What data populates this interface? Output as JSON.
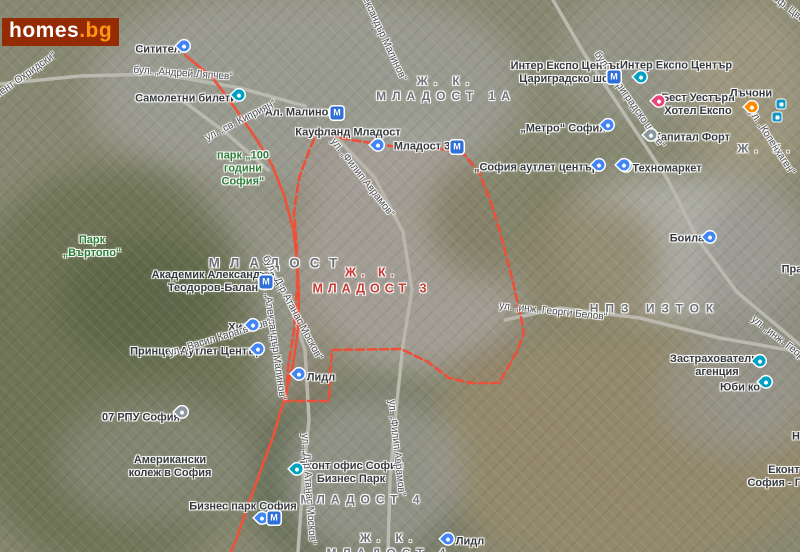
{
  "page": {
    "width": 800,
    "height": 552
  },
  "brand": {
    "logo_main": "homes",
    "logo_suffix": ".bg",
    "logo_bg": "#952b05",
    "logo_main_color": "#ffffff",
    "logo_suffix_color": "#ff9412"
  },
  "map": {
    "colors": {
      "boundary": "#ee4f38",
      "highlight_road": "#ee5238",
      "base_road": "#b9b9af",
      "district_text": "#6e7277",
      "district_highlight_text": "#c63b30",
      "park_text": "#2d7d37",
      "place_text": "#35393d",
      "street_text": "#4c5055",
      "pin_blue": "#4285f4",
      "pin_teal": "#00a1c2",
      "pin_pink": "#e7467c",
      "pin_orange": "#fb8c00",
      "pin_gray": "#8a97a0",
      "metro_icon_bg": "#2e6fd8",
      "bus_icon_bg": "#1596c6"
    },
    "metro_glyph": "М",
    "districts": [
      {
        "id": "mladost-1a",
        "lines": [
          "Ж. К.",
          "МЛАДОСТ 1А"
        ],
        "x": 446,
        "y": 88,
        "size": 12,
        "ls": 6
      },
      {
        "id": "mladost",
        "lines": [
          "МЛАДОСТ"
        ],
        "x": 278,
        "y": 263,
        "size": 13.5,
        "ls": 10
      },
      {
        "id": "mladost-3",
        "lines": [
          "Ж. К.",
          "МЛАДОСТ 3"
        ],
        "x": 372,
        "y": 280,
        "size": 12.5,
        "ls": 5,
        "color": "#c63b30"
      },
      {
        "id": "npz-iztok",
        "lines": [
          "НПЗ ИЗТОК"
        ],
        "x": 655,
        "y": 308,
        "size": 12,
        "ls": 7
      },
      {
        "id": "mladost-4",
        "lines": [
          "МЛАДОСТ 4"
        ],
        "x": 363,
        "y": 499,
        "size": 12,
        "ls": 6
      },
      {
        "id": "zhk-mladost-4",
        "lines": [
          "Ж. К.",
          "МЛАДОСТ 4"
        ],
        "x": 389,
        "y": 545,
        "size": 12,
        "ls": 6
      },
      {
        "id": "druzhba",
        "lines": [
          "Ж. К. ДРУЖБА"
        ],
        "x": 815,
        "y": 148,
        "size": 12,
        "ls": 6
      }
    ],
    "places": [
      {
        "id": "sititel",
        "lines": [
          "Ситител"
        ],
        "x": 158,
        "y": 50
      },
      {
        "id": "samoletni-bileti",
        "lines": [
          "Самолетни билети"
        ],
        "x": 186,
        "y": 99
      },
      {
        "id": "al-malinov-station",
        "lines": [
          "Ал. Малинов"
        ],
        "x": 300,
        "y": 113
      },
      {
        "id": "kaufland-mladost",
        "lines": [
          "Кауфланд Младост"
        ],
        "x": 348,
        "y": 133
      },
      {
        "id": "mladost-3-station",
        "lines": [
          "Младост 3"
        ],
        "x": 422,
        "y": 147
      },
      {
        "id": "park-100-godini-sofia",
        "lines": [
          "парк „100",
          "години",
          "София“"
        ],
        "x": 243,
        "y": 169,
        "color": "#2d7d37"
      },
      {
        "id": "inter-expo-station",
        "lines": [
          "Интер Експо Център -",
          "Цариградско шосе"
        ],
        "x": 570,
        "y": 73
      },
      {
        "id": "inter-expo-center",
        "lines": [
          "Интер Експо Център"
        ],
        "x": 676,
        "y": 66
      },
      {
        "id": "best-western-hotel-expo",
        "lines": [
          "Бест Уестърн",
          "Хотел Експо"
        ],
        "x": 698,
        "y": 105
      },
      {
        "id": "lachoni",
        "lines": [
          "Лъчони"
        ],
        "x": 751,
        "y": 94
      },
      {
        "id": "metro-sofia",
        "lines": [
          "„Метро“ София"
        ],
        "x": 563,
        "y": 129
      },
      {
        "id": "kapital-fort",
        "lines": [
          "Капитал Форт"
        ],
        "x": 692,
        "y": 138
      },
      {
        "id": "tehnomarket",
        "lines": [
          "Техномаркет"
        ],
        "x": 667,
        "y": 169
      },
      {
        "id": "sofia-outlet-center",
        "lines": [
          "„София аутлет център“"
        ],
        "x": 539,
        "y": 168
      },
      {
        "id": "boila",
        "lines": [
          "Боила"
        ],
        "x": 687,
        "y": 239
      },
      {
        "id": "praktiker",
        "lines": [
          "Практикер"
        ],
        "x": 810,
        "y": 270
      },
      {
        "id": "park-vartopo",
        "lines": [
          "Парк",
          "„Въртопо“"
        ],
        "x": 92,
        "y": 247,
        "color": "#2d7d37"
      },
      {
        "id": "akademik-teodorov-balan",
        "lines": [
          "Академик Александър",
          "Теодоров-Балан"
        ],
        "x": 213,
        "y": 282
      },
      {
        "id": "zastrahovatelna-agencia",
        "lines": [
          "Застрахователна",
          "агенция"
        ],
        "x": 717,
        "y": 366
      },
      {
        "id": "yubi-ko",
        "lines": [
          "Юби ко"
        ],
        "x": 740,
        "y": 388
      },
      {
        "id": "rpu-07-sofia",
        "lines": [
          "07 РПУ София"
        ],
        "x": 141,
        "y": 418
      },
      {
        "id": "american-college-sofia",
        "lines": [
          "Американски",
          "колеж в София"
        ],
        "x": 170,
        "y": 467
      },
      {
        "id": "hit",
        "lines": [
          "Хит"
        ],
        "x": 238,
        "y": 328
      },
      {
        "id": "princess-outlet-center",
        "lines": [
          "Принцес Аутлет Център"
        ],
        "x": 196,
        "y": 352
      },
      {
        "id": "lidl-west",
        "lines": [
          "Лидл"
        ],
        "x": 321,
        "y": 378
      },
      {
        "id": "ekont-business-park",
        "lines": [
          "Еконт офис София",
          "Бизнес Парк"
        ],
        "x": 351,
        "y": 473
      },
      {
        "id": "business-park-sofia",
        "lines": [
          "Бизнес парк София"
        ],
        "x": 243,
        "y": 507
      },
      {
        "id": "lidl-south",
        "lines": [
          "Лидл"
        ],
        "x": 470,
        "y": 542
      },
      {
        "id": "ekont-gorublyane",
        "lines": [
          "Еконт офис",
          "София - Горубляне"
        ],
        "x": 800,
        "y": 477
      },
      {
        "id": "partial-n",
        "lines": [
          "Н"
        ],
        "x": 796,
        "y": 437
      }
    ],
    "streets": [
      {
        "id": "andrey-lyapchev",
        "text": "бул. „Андрей Ляпчев“",
        "x": 183,
        "y": 74,
        "rot": 4
      },
      {
        "id": "sv-kipriyan",
        "text": "ул. „св. Киприян“",
        "x": 241,
        "y": 121,
        "rot": -27
      },
      {
        "id": "kliment-ohridski",
        "text": "бул. „Климент Охридски“",
        "x": 8,
        "y": 88,
        "rot": -35
      },
      {
        "id": "al-malinov-top",
        "text": "бул. „Александър Малинов“",
        "x": 376,
        "y": 22,
        "rot": 65
      },
      {
        "id": "filip-avramov-1",
        "text": "ул. „Филип Аврамов“",
        "x": 362,
        "y": 178,
        "rot": 52
      },
      {
        "id": "filip-avramov-2",
        "text": "ул. „Филип Аврамов“",
        "x": 396,
        "y": 448,
        "rot": 84
      },
      {
        "id": "atanas-moskov-1",
        "text": "бул. „Д-р Атанас Москов“",
        "x": 292,
        "y": 308,
        "rot": 62
      },
      {
        "id": "atanas-moskov-2",
        "text": "ул. „Д-р Атанас Москов“",
        "x": 308,
        "y": 489,
        "rot": 86
      },
      {
        "id": "al-malinov-mid",
        "text": "бул. „Александър Малинов“",
        "x": 273,
        "y": 336,
        "rot": 82
      },
      {
        "id": "vasil-karagyozov",
        "text": "ул. „Васил Карагьозов“",
        "x": 220,
        "y": 338,
        "rot": -17
      },
      {
        "id": "tsarigradsko-shose",
        "text": "бул. „Цариградско шосе“",
        "x": 629,
        "y": 100,
        "rot": 55
      },
      {
        "id": "georgi-belov-1",
        "text": "ул. „инж. Георги Белов“",
        "x": 553,
        "y": 312,
        "rot": 6
      },
      {
        "id": "georgi-belov-2",
        "text": "ул. „инж. Георги Белов“",
        "x": 795,
        "y": 352,
        "rot": 38
      },
      {
        "id": "prof-tsvetan-lazarov",
        "text": "ул. „проф. Цветан Лазаров“",
        "x": 800,
        "y": 18,
        "rot": 38
      },
      {
        "id": "kopenhagen",
        "text": "бул. „Копенхаген“",
        "x": 770,
        "y": 140,
        "rot": 57
      }
    ],
    "markers": [
      {
        "id": "sititel-pin",
        "type": "pin",
        "color": "#4285f4",
        "x": 184,
        "y": 47
      },
      {
        "id": "samoletni-bileti-pin",
        "type": "pin",
        "color": "#00a1c2",
        "x": 239,
        "y": 96
      },
      {
        "id": "kaufland-pin",
        "type": "pin",
        "color": "#4285f4",
        "x": 378,
        "y": 146
      },
      {
        "id": "inter-expo-center-pin",
        "type": "pin",
        "color": "#00a1c2",
        "x": 641,
        "y": 78
      },
      {
        "id": "best-western-pin",
        "type": "pin",
        "color": "#e7467c",
        "x": 659,
        "y": 102
      },
      {
        "id": "lachoni-pin",
        "type": "pin",
        "color": "#fb8c00",
        "x": 752,
        "y": 108
      },
      {
        "id": "metro-sofia-pin",
        "type": "pin",
        "color": "#4285f4",
        "x": 608,
        "y": 126
      },
      {
        "id": "kapital-fort-pin",
        "type": "pin",
        "color": "#8a97a0",
        "x": 651,
        "y": 136
      },
      {
        "id": "tehnomarket-pin",
        "type": "pin",
        "color": "#4285f4",
        "x": 626,
        "y": 167
      },
      {
        "id": "sofia-outlet-pin-1",
        "type": "pin",
        "color": "#4285f4",
        "x": 599,
        "y": 166
      },
      {
        "id": "sofia-outlet-pin-2",
        "type": "pin",
        "color": "#4285f4",
        "x": 624,
        "y": 166
      },
      {
        "id": "boila-pin",
        "type": "pin",
        "color": "#4285f4",
        "x": 710,
        "y": 238
      },
      {
        "id": "hit-pin",
        "type": "pin",
        "color": "#4285f4",
        "x": 253,
        "y": 326
      },
      {
        "id": "princess-outlet-pin",
        "type": "pin",
        "color": "#4285f4",
        "x": 258,
        "y": 350
      },
      {
        "id": "lidl-west-pin",
        "type": "pin",
        "color": "#4285f4",
        "x": 299,
        "y": 375
      },
      {
        "id": "zastrahovatelna-pin",
        "type": "pin",
        "color": "#00a1c2",
        "x": 760,
        "y": 362
      },
      {
        "id": "yubi-ko-pin",
        "type": "pin",
        "color": "#00a1c2",
        "x": 766,
        "y": 383
      },
      {
        "id": "rpu-07-pin",
        "type": "pin",
        "color": "#8a97a0",
        "x": 182,
        "y": 413
      },
      {
        "id": "ekont-business-park-pin",
        "type": "pin",
        "color": "#00a1c2",
        "x": 297,
        "y": 470
      },
      {
        "id": "business-park-pin",
        "type": "pin",
        "color": "#4285f4",
        "x": 262,
        "y": 519
      },
      {
        "id": "lidl-south-pin",
        "type": "pin",
        "color": "#4285f4",
        "x": 448,
        "y": 540
      },
      {
        "id": "al-malinov-metro",
        "type": "metro",
        "x": 337,
        "y": 113
      },
      {
        "id": "mladost-3-metro",
        "type": "metro",
        "x": 457,
        "y": 147
      },
      {
        "id": "inter-expo-metro",
        "type": "metro",
        "x": 614,
        "y": 77
      },
      {
        "id": "teodorov-balan-metro",
        "type": "metro",
        "x": 266,
        "y": 282
      },
      {
        "id": "business-park-metro",
        "type": "metro",
        "x": 274,
        "y": 518
      },
      {
        "id": "bus-stop-1",
        "type": "bus",
        "x": 781,
        "y": 104
      },
      {
        "id": "bus-stop-2",
        "type": "bus",
        "x": 777,
        "y": 117
      }
    ],
    "boundary_polygon": "318,130 345,139 372,143 403,148 433,148 462,152 479,172 492,205 503,243 512,278 520,312 524,333 517,352 499,383 471,383 449,378 428,362 401,349 332,350 330,377 329,401 286,401 288,368 294,330 297,288 297,247 294,213 299,178 309,151",
    "highlight_road": "185,55 212,77 235,108 257,140 272,165 284,195 293,228 297,260 299,295 298,330 293,365 284,400 273,437 259,475 247,508 236,540 231,552",
    "base_roads": [
      {
        "id": "road-lyapchev",
        "points": "0,84 80,76 160,74 240,88 305,106"
      },
      {
        "id": "road-tsarigradsko",
        "points": "553,0 585,55 625,115 668,180 697,238 737,292 800,345"
      },
      {
        "id": "road-avramov",
        "points": "332,133 375,178 403,232 412,290 403,345 396,410 390,480 388,552"
      },
      {
        "id": "road-moskov",
        "points": "268,262 290,305 305,350 309,420 303,480 298,552"
      },
      {
        "id": "road-belov",
        "points": "505,320 560,308 640,318 720,338 800,352"
      },
      {
        "id": "road-kipriyan",
        "points": "175,95 225,132 268,170"
      }
    ]
  }
}
